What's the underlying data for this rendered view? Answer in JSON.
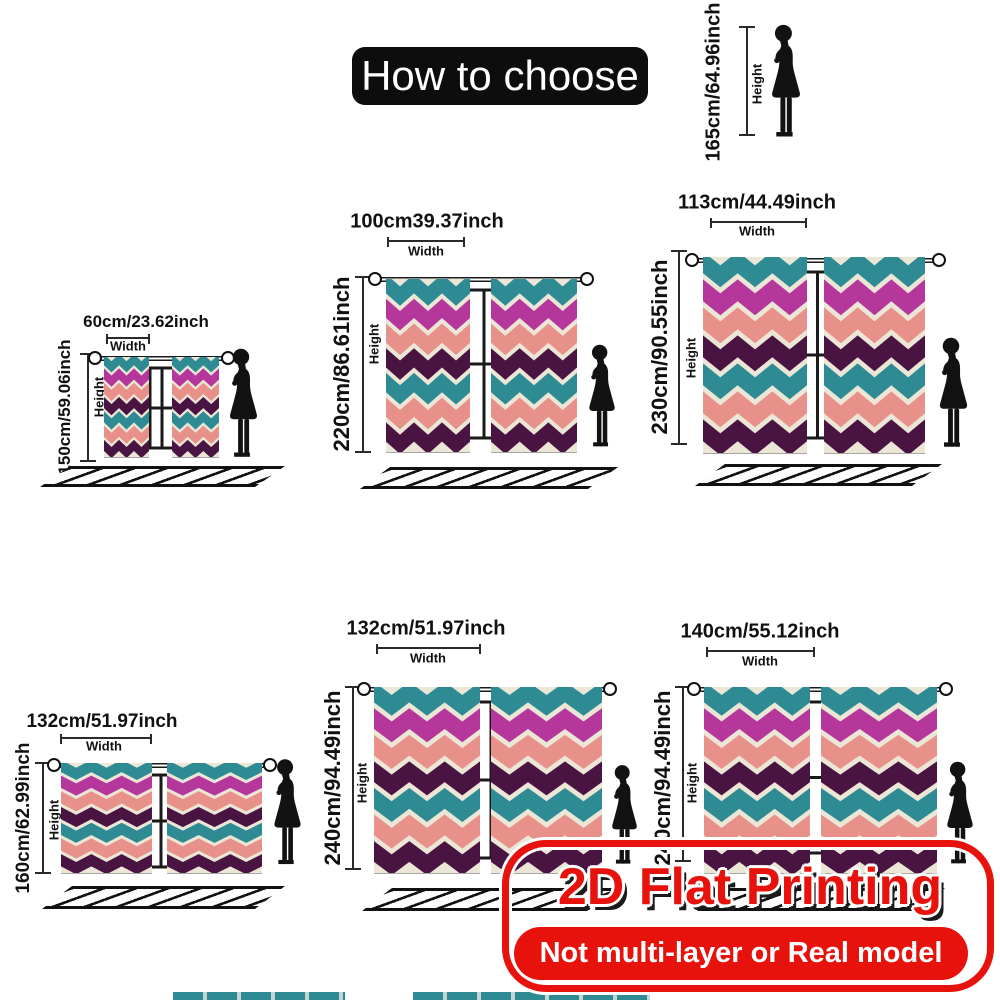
{
  "title": "How to choose",
  "reference": {
    "height": "165cm/64.96inch",
    "height_label": "Height"
  },
  "labels": {
    "width": "Width",
    "height": "Height"
  },
  "sets": [
    {
      "width": "60cm/23.62inch",
      "height": "150cm/59.06inch"
    },
    {
      "width": "100cm39.37inch",
      "height": "220cm/86.61inch"
    },
    {
      "width": "113cm/44.49inch",
      "height": "230cm/90.55inch"
    },
    {
      "width": "132cm/51.97inch",
      "height": "160cm/62.99inch"
    },
    {
      "width": "132cm/51.97inch",
      "height": "240cm/94.49inch"
    },
    {
      "width": "140cm/55.12inch",
      "height": "240cm/94.49inch"
    }
  ],
  "banner": {
    "title": "2D Flat Printing",
    "subtitle": "Not multi-layer or Real model"
  },
  "colors": {
    "accent_red": "#e8120c",
    "title_bg": "#0d0d0d",
    "curtain_teal": "#2e8b93",
    "curtain_magenta": "#b5379b",
    "curtain_salmon": "#e8918b",
    "curtain_plum": "#4a1442",
    "curtain_cream": "#ece6d6"
  }
}
